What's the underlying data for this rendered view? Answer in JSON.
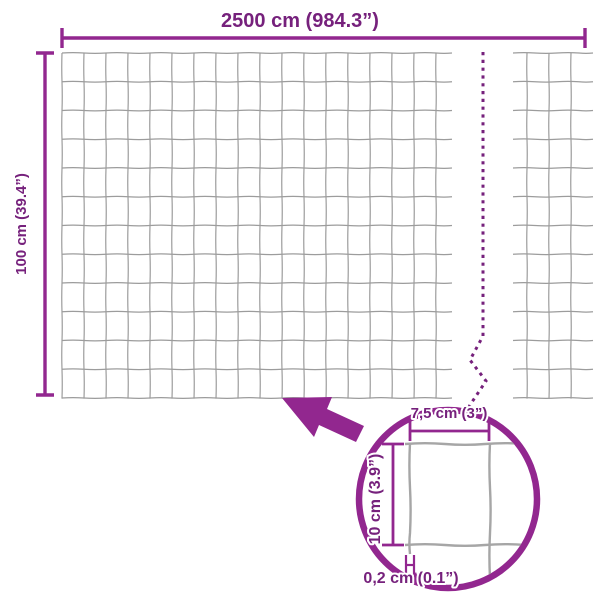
{
  "diagram": {
    "labels": {
      "width": "2500 cm (984.3”)",
      "height": "100 cm (39.4”)",
      "cell_width": "7,5 cm (3”)",
      "cell_height": "10 cm (3.9”)",
      "wire_thickness": "0,2 cm (0.1”)"
    },
    "colors": {
      "accent_line": "#92278F",
      "accent_text": "#76217C",
      "mesh_line": "#9C9C9C",
      "wire_line": "#A6A6A6",
      "background": "#FFFFFF"
    },
    "mesh": {
      "rows": 12,
      "left_section_columns": 17,
      "right_section_columns": 3
    }
  }
}
